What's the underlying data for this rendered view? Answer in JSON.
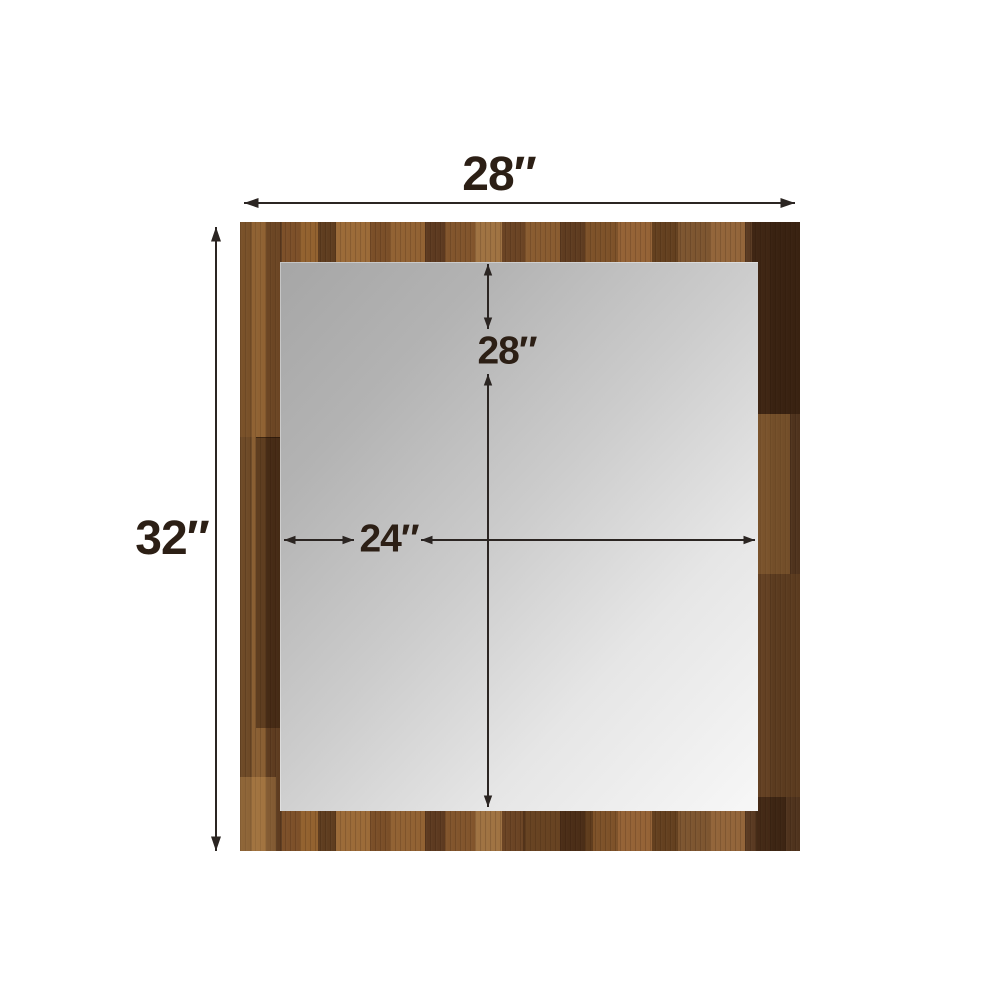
{
  "diagram": {
    "description": "Dimension diagram of a rectangular wood-framed mirror on a white background",
    "frame_width_label": "28″",
    "frame_height_label": "32″",
    "mirror_height_label": "28″",
    "mirror_width_label": "24″"
  },
  "colors": {
    "background": "#ffffff",
    "dimension_line": "#2b2522",
    "label_text": "#2c1f15",
    "wood_medium": "#7e5229",
    "wood_dark": "#54341c",
    "wood_light": "#9c6b38",
    "mirror_gray_dark": "#a6a6a6",
    "mirror_gray_light": "#f7f7f7"
  }
}
